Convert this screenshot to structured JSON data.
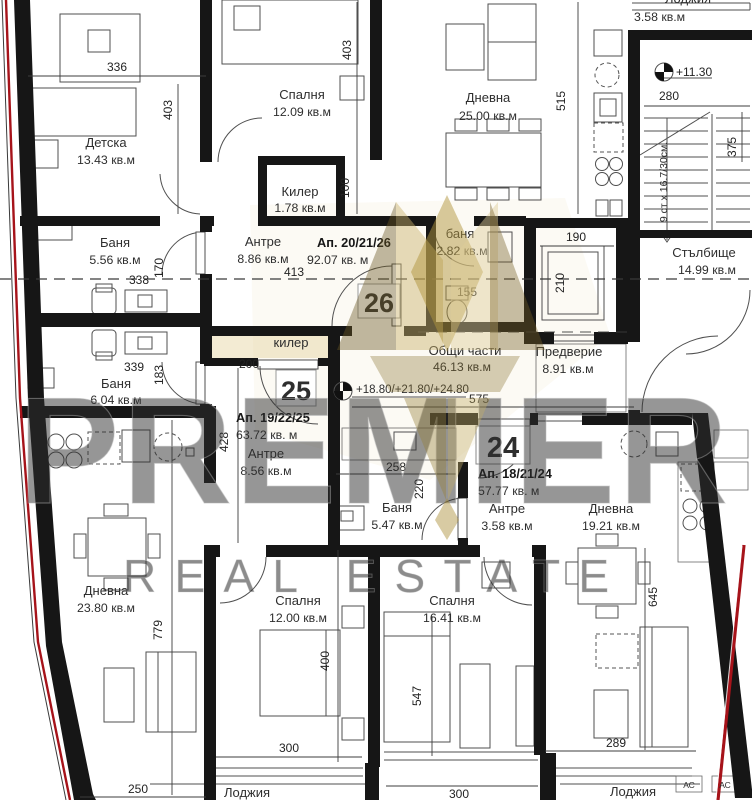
{
  "colors": {
    "wall_black": "#161616",
    "badge_red": "#c22730",
    "boundary_red": "#a6131a",
    "watermark_gold": "#b2953e"
  },
  "watermark": {
    "brand": "PREMIER",
    "tagline": "REAL ESTATE"
  },
  "apartments": [
    {
      "badge": "26",
      "label": "Ап. 20/21/26",
      "area": "92.07 кв. м"
    },
    {
      "badge": "25",
      "label": "Ап. 19/22/25",
      "area": "63.72 кв. м"
    },
    {
      "badge": "24",
      "label": "Ап. 18/21/24",
      "area": "57.77 кв. м"
    }
  ],
  "rooms": [
    {
      "name": "Детска",
      "area": "13.43 кв.м"
    },
    {
      "name": "Спалня",
      "area": "12.09 кв.м"
    },
    {
      "name": "Килер",
      "area": "1.78 кв.м"
    },
    {
      "name": "Дневна",
      "area": "25.00 кв.м"
    },
    {
      "name": "Лоджия",
      "area": "3.58 кв.м"
    },
    {
      "name": "Стълбище",
      "area": "14.99 кв.м"
    },
    {
      "name": "Баня",
      "area": "5.56 кв.м"
    },
    {
      "name": "Баня",
      "area": "6.04 кв.м"
    },
    {
      "name": "Антре",
      "area": "8.86 кв.м"
    },
    {
      "name": "баня",
      "area": "2.82 кв.м"
    },
    {
      "name": "Общи части",
      "area": "46.13 кв.м"
    },
    {
      "name": "Предверие",
      "area": "8.91 кв.м"
    },
    {
      "name": "килер",
      "area": ""
    },
    {
      "name": "Антре",
      "area": "8.56 кв.м"
    },
    {
      "name": "Баня",
      "area": "5.47 кв.м"
    },
    {
      "name": "Антре",
      "area": "3.58 кв.м"
    },
    {
      "name": "Дневна",
      "area": "19.21 кв.м"
    },
    {
      "name": "Дневна",
      "area": "23.80 кв.м"
    },
    {
      "name": "Спалня",
      "area": "12.00 кв.м"
    },
    {
      "name": "Спалня",
      "area": "16.41 кв.м"
    },
    {
      "name": "Лоджия",
      "area": ""
    },
    {
      "name": "Лоджия",
      "area": ""
    }
  ],
  "levels": {
    "upper": "+11.30",
    "corridor": "+18.80/+21.80/+24.80"
  },
  "stairs_note": "9 ст х 16.7/30см.",
  "dims": {
    "t336": "336",
    "l403": "403",
    "r403": "403",
    "k100": "100",
    "d515": "515",
    "s280": "280",
    "s375": "375",
    "b338": "338",
    "b170": "170",
    "b339": "339",
    "b183": "183",
    "a413": "413",
    "b155": "155",
    "l190": "190",
    "l210": "210",
    "k200": "200",
    "a428": "428",
    "c575": "575",
    "s258": "258",
    "s220": "220",
    "d779": "779",
    "s400": "400",
    "s300a": "300",
    "s547": "547",
    "s300b": "300",
    "d645": "645",
    "d289": "289",
    "b250": "250",
    "ac1": "АС",
    "ac2": "АС"
  }
}
